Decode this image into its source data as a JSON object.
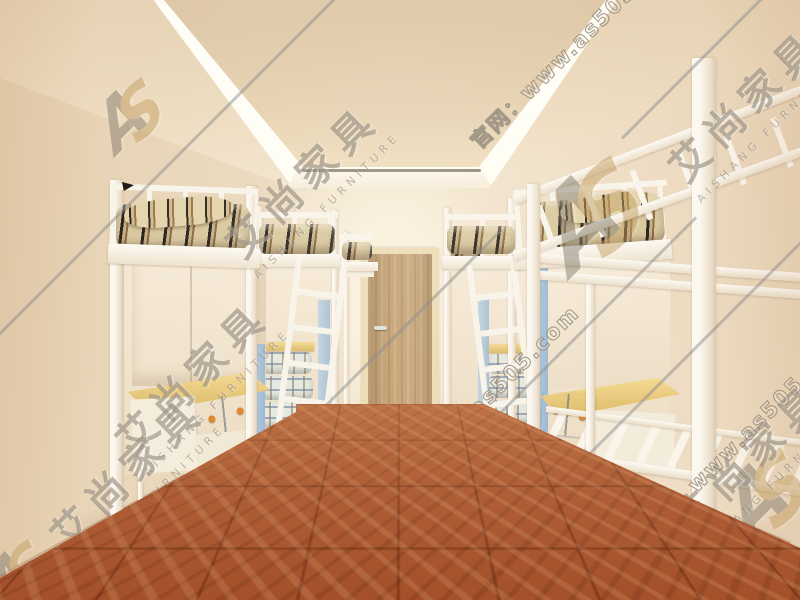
{
  "meta": {
    "kind": "3d-interior-render",
    "subject": "student dormitory room with white loft beds, desks, wardrobes and a bare bunk frame"
  },
  "watermark": {
    "logo_a": "A",
    "logo_s": "S",
    "brand": "艾尚家具",
    "brand_sub": "AISHANG FURNITURE",
    "site": "官网：www.as505.com",
    "ink_color": "#857a6a",
    "logo_gold": "#c19d5f"
  },
  "palette": {
    "ceiling_panel": "#e2cdae",
    "cove_light": "#fffef6",
    "wall": "#f2e2c8",
    "door_wood": "#c3a071",
    "floor_parquet": "#a4512b",
    "frame_white": "#f8f2e8",
    "desk_wood": "#ecca7e",
    "drawer_blue": "#9fbad4",
    "knob_orange": "#e0892e",
    "wardrobe_panel_blue": "#a9c6dd",
    "bedding_stripe_dark": "#26201a",
    "bedding_stripe_tan": "#8a6a42",
    "bedding_base": "#d9c89e",
    "plaid_bedding": "#e4e8de"
  }
}
